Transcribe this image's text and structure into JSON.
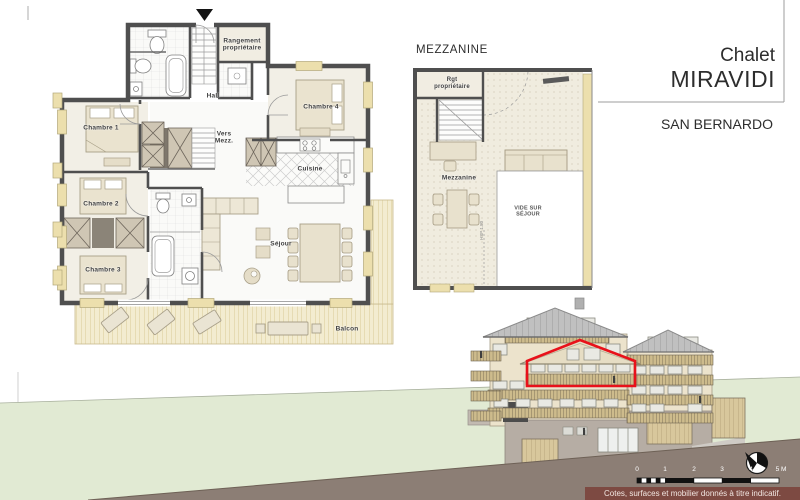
{
  "title_block": {
    "project": "Chalet",
    "name": "MIRAVIDI",
    "location": "SAN BERNARDO"
  },
  "main_plan": {
    "rooms": {
      "chambre1": "Chambre 1",
      "chambre2": "Chambre 2",
      "chambre3": "Chambre 3",
      "chambre4": "Chambre 4",
      "hall": "Hall",
      "cuisine": "Cuisine",
      "sejour": "Séjour",
      "balcon": "Balcon",
      "vers_mezz": "Vers Mezz.",
      "rangement": "Rangement propriétaire"
    }
  },
  "mezzanine": {
    "title": "MEZZANINE",
    "labels": {
      "rgt": "Rgt propriétaire",
      "mezzanine": "Mezzanine",
      "vide": "VIDE SUR SÉJOUR",
      "hsp": "HSP 1.80"
    }
  },
  "footer": {
    "disclaimer": "Cotes, surfaces et mobilier donnés à titre indicatif.",
    "scale_labels": [
      "0",
      "1",
      "2",
      "3",
      "4",
      "5 M"
    ]
  },
  "colors": {
    "accent_red": "#e8111a",
    "wall": "#4f4f4f",
    "window_sill": "#ecdfad",
    "deck": "#f3ecd0",
    "hill_green": "#e1ead3",
    "slope_brown": "#8c7e75",
    "disclaimer_bg": "#7d4a42",
    "roof_gray": "#c0c0c0",
    "facade_beige": "#ece3cc",
    "balcony_tan": "#cdbb8c"
  }
}
